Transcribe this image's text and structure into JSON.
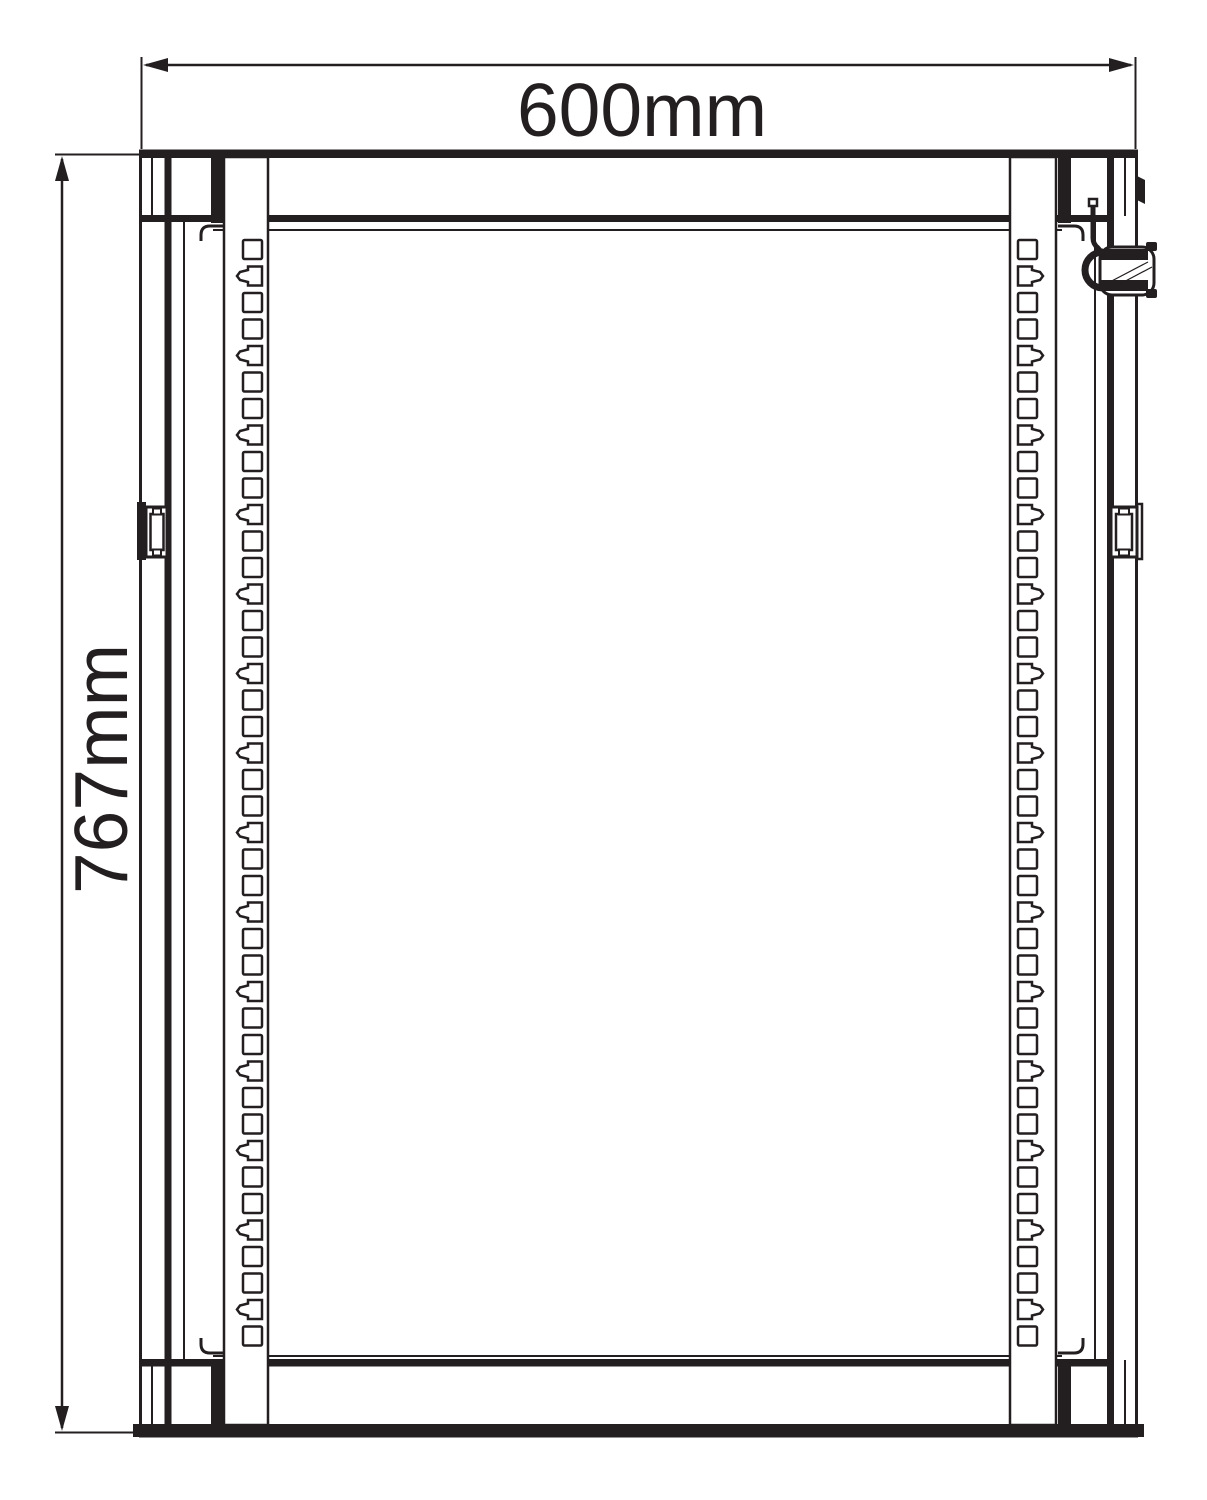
{
  "diagram": {
    "type": "technical-drawing",
    "subject": "rack-cabinet-front-elevation",
    "background": "#ffffff",
    "ink": "#231f20",
    "width_dimension": {
      "label": "600mm"
    },
    "height_dimension": {
      "label": "767mm"
    }
  },
  "geometry": {
    "hole_count": 42,
    "notch_interval": 3,
    "notch_offset": 1,
    "first_hole_y": 240,
    "pitch": 26.5,
    "hole_width": 19,
    "hole_height": 19,
    "left_hole_x": 243,
    "right_hole_x": 1018,
    "notch_depth": 6
  }
}
